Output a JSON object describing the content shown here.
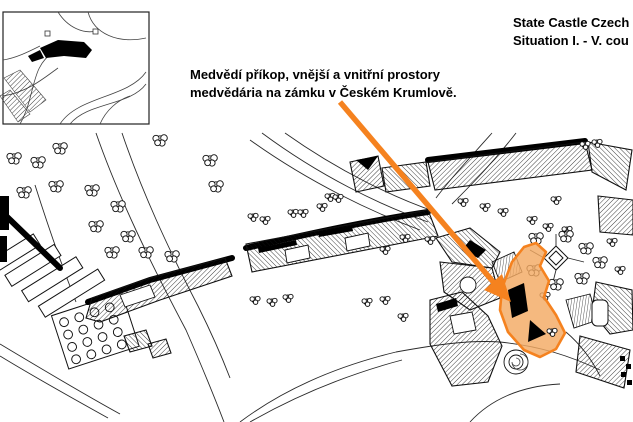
{
  "header": {
    "title_line1": "State Castle Czech",
    "title_line2": "Situation I. - V. cou"
  },
  "annotation": {
    "line1": "Medvědí příkop, vnější a vnitřní prostory",
    "line2": "medvědária na zámku v Českém Krumlově."
  },
  "colors": {
    "arrow_orange": "#f5821f",
    "moat_fill_orange": "#f3a963",
    "map_line": "#111111",
    "background": "#ffffff"
  }
}
